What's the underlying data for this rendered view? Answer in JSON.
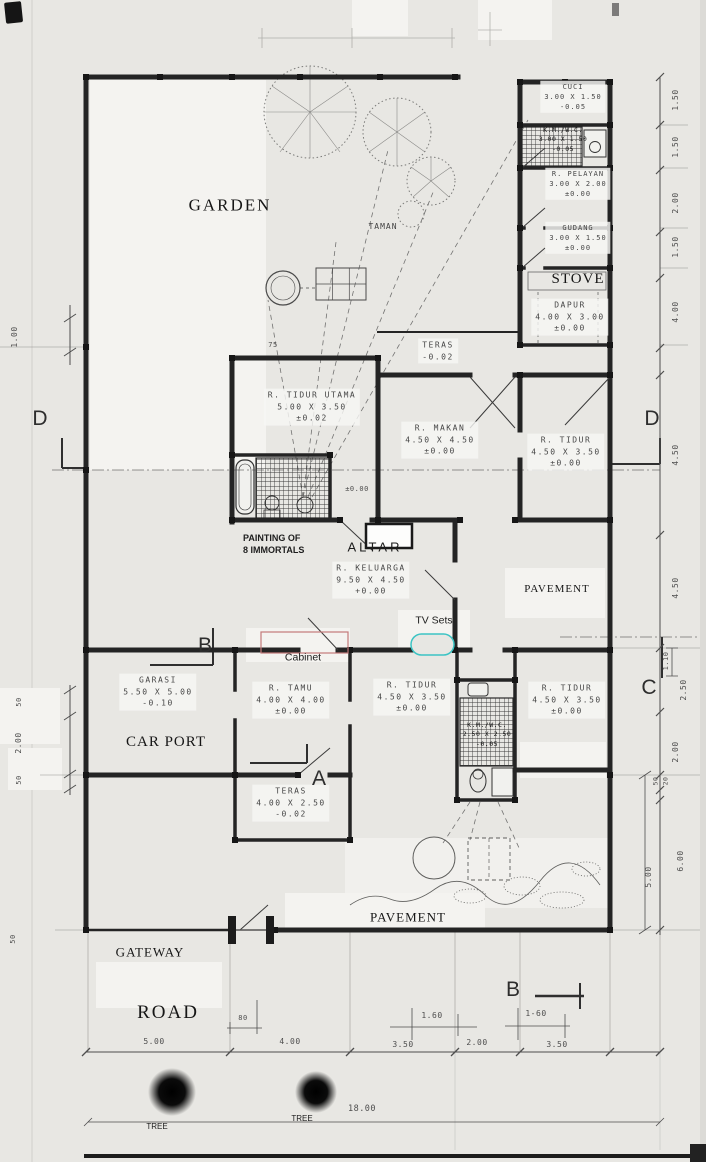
{
  "colors": {
    "paper": "#e8e7e3",
    "ink": "#242424",
    "dimension_lines": "#4e4e4e",
    "cabinet_outline": "#c47a7a",
    "tv_outline": "#3cc4c4",
    "tree_blob": "#0a0a0a"
  },
  "rooms": [
    {
      "name": "CUCI",
      "size": "3.00 X 1.50",
      "level": "-0.05"
    },
    {
      "name": "K.M./W.C.",
      "size": "3.00 X 1.50",
      "level": "-0.05"
    },
    {
      "name": "R. PELAYAN",
      "size": "3.00 X 2.00",
      "level": "±0.00"
    },
    {
      "name": "GUDANG",
      "size": "3.00 X 1.50",
      "level": "±0.00"
    },
    {
      "name": "DAPUR",
      "size": "4.00 X 3.00",
      "level": "±0.00"
    },
    {
      "name": "TERAS",
      "size": "",
      "level": "-0.02"
    },
    {
      "name": "R. TIDUR UTAMA",
      "size": "5.00 X 3.50",
      "level": "±0.02"
    },
    {
      "name": "R. MAKAN",
      "size": "4.50 X 4.50",
      "level": "±0.00"
    },
    {
      "name": "R. TIDUR",
      "size": "4.50 X 3.50",
      "level": "±0.00"
    },
    {
      "name": "R. KELUARGA",
      "size": "9.50 X 4.50",
      "level": "+0.00"
    },
    {
      "name": "GARASI",
      "size": "5.50 X 5.00",
      "level": "-0.10"
    },
    {
      "name": "R. TAMU",
      "size": "4.00 X 4.00",
      "level": "±0.00"
    },
    {
      "name": "R. TIDUR",
      "size": "4.50 X 3.50",
      "level": "±0.00"
    },
    {
      "name": "K.M./W.C.",
      "size": "2.50 X 2.50",
      "level": "-0.05"
    },
    {
      "name": "R. TIDUR",
      "size": "4.50 X 3.50",
      "level": "±0.00"
    },
    {
      "name": "TERAS",
      "size": "4.00 X 2.50",
      "level": "-0.02"
    }
  ],
  "annotations": {
    "garden": "GARDEN",
    "taman": "TAMAN",
    "stove": "STOVE",
    "car_port": "CAR PORT",
    "painting_line1": "PAINTING OF",
    "painting_line2": "8 IMMORTALS",
    "altar": "ALTAR",
    "tv_sets": "TV Sets",
    "cabinet": "Cabinet",
    "pavement_right": "PAVEMENT",
    "pavement_bottom": "PAVEMENT",
    "gateway": "GATEWAY",
    "road": "ROAD",
    "tree_left": "TREE",
    "tree_right": "TREE"
  },
  "section_markers": {
    "d_left": "D",
    "d_right": "D",
    "c_right": "C",
    "b_left": "B",
    "a_bottom": "A",
    "b_bottom": "B"
  },
  "dimensions": {
    "bottom": [
      "5.00",
      "80",
      "4.00",
      "3.50",
      "1.60",
      "2.00",
      "1-60",
      "3.50"
    ],
    "right": [
      "1.50",
      "1.50",
      "2.00",
      "1.50",
      "4.00",
      "4.50",
      "4.50",
      "1.10",
      "2.50",
      "2.00",
      "50",
      "20",
      "6.00",
      "5.00"
    ],
    "left": [
      "1.00",
      "50",
      "2.00",
      "50",
      "50"
    ],
    "other": {
      "width_75": "75",
      "total_18": "18.00",
      "bath_level": "±0.00"
    }
  }
}
